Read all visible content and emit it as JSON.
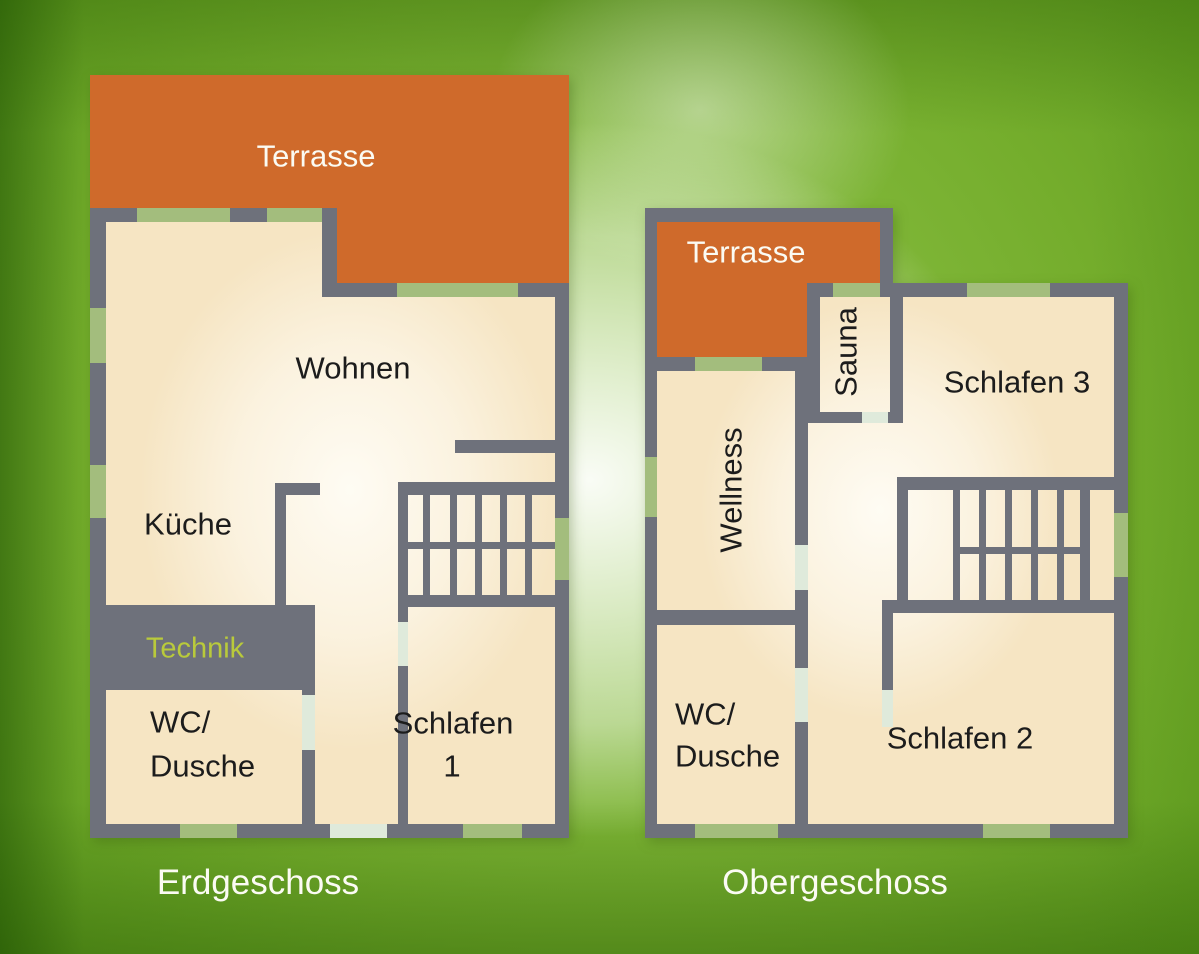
{
  "colors": {
    "background_green": "#79b231",
    "wall_gray": "#6e717b",
    "terrace_orange": "#cf6a2b",
    "room_cream": "#f6e5c3",
    "window_sage": "#a3bd7d",
    "door_mint": "#dfeadb",
    "technik_text": "#b9ca3b",
    "room_text": "#1c1c1c",
    "light_text": "#fbfbf3"
  },
  "floors": {
    "eg": {
      "title": "Erdgeschoss",
      "terrace_label": "Terrasse",
      "rooms": {
        "wohnen": "Wohnen",
        "kueche": "Küche",
        "technik": "Technik",
        "wc_line1": "WC/",
        "wc_line2": "Dusche",
        "schlafen1_line1": "Schlafen",
        "schlafen1_line2": "1"
      }
    },
    "og": {
      "title": "Obergeschoss",
      "terrace_label": "Terrasse",
      "rooms": {
        "sauna": "Sauna",
        "wellness": "Wellness",
        "schlafen3": "Schlafen 3",
        "wc_line1": "WC/",
        "wc_line2": "Dusche",
        "schlafen2": "Schlafen 2"
      }
    }
  }
}
